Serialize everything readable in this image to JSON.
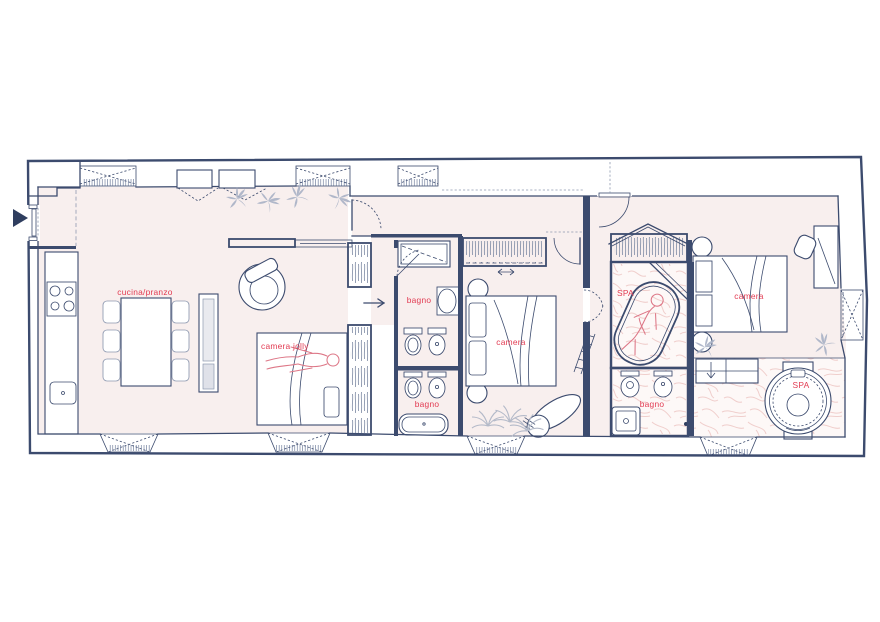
{
  "document": {
    "type": "apartment-floor-plan"
  },
  "colors": {
    "wall": "#3c4b6e",
    "ink": "#2f3e5f",
    "muted": "#8e99b0",
    "floor": "#f8efee",
    "marble": "#eec7c4",
    "label": "#e23b52",
    "person": "#dd7787",
    "plant": "#a9b2c6",
    "paper": "#ffffff"
  },
  "entry": {
    "marker": "entrance-arrow"
  },
  "rooms": [
    {
      "id": "kitchen-dining",
      "label": "cucina/pranzo"
    },
    {
      "id": "jolly-bedroom",
      "label": "camera jolly"
    },
    {
      "id": "bathroom-top",
      "label": "bagno"
    },
    {
      "id": "bedroom-middle",
      "label": "camera"
    },
    {
      "id": "bathroom-bottom",
      "label": "bagno"
    },
    {
      "id": "spa-bath",
      "label": "SPA"
    },
    {
      "id": "bedroom-right",
      "label": "camera"
    },
    {
      "id": "bathroom-right",
      "label": "bagno"
    },
    {
      "id": "spa-jacuzzi",
      "label": "SPA"
    }
  ]
}
